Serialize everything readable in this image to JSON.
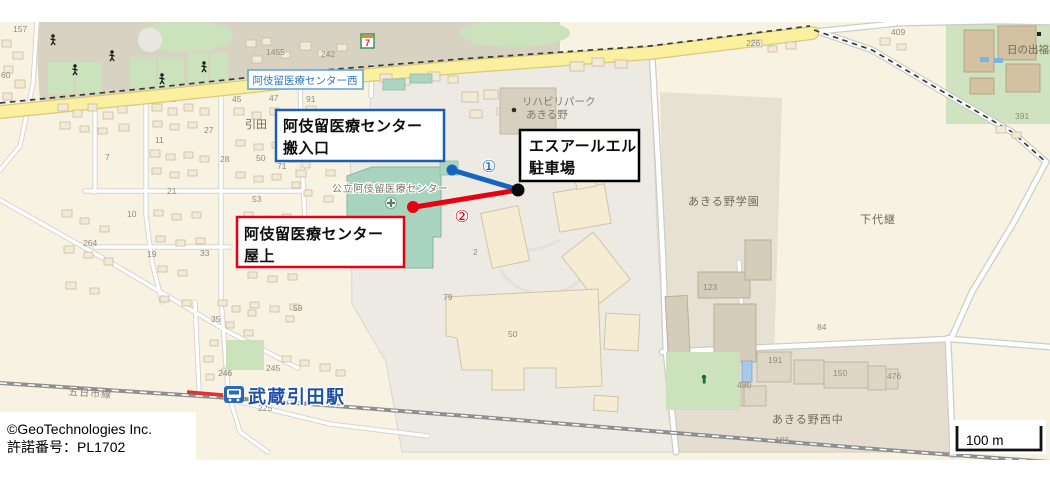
{
  "window": {
    "width": 1050,
    "height": 479
  },
  "annotations": {
    "loading_entrance": {
      "line1": "阿伎留医療センター",
      "line2": "搬入口",
      "border": "#1c5fb0"
    },
    "srl_parking": {
      "line1": "エスアールエル",
      "line2": "駐車場",
      "border": "#000000"
    },
    "rooftop": {
      "line1": "阿伎留医療センター",
      "line2": "屋上",
      "border": "#e60012"
    }
  },
  "routes": {
    "badge1": "①",
    "badge2": "②",
    "color1": "#1565c0",
    "color2": "#e60012",
    "endpoint_color": "#0a0a0a"
  },
  "poi": {
    "bus_stop": "阿伎留医療センター西",
    "station": "武蔵引田駅",
    "convenience_store": "7",
    "hospital": "公立阿伎留医療センター"
  },
  "footer": {
    "copyright_line1": "©GeoTechnologies Inc.",
    "copyright_line2": "許諾番号：PL1702"
  },
  "scale": {
    "label": "100 m"
  },
  "map_labels": [
    {
      "t": "引田",
      "x": 245,
      "y": 128,
      "s": 11,
      "c": "#6f695a"
    },
    {
      "t": "あきる野学園",
      "x": 688,
      "y": 205,
      "s": 11,
      "c": "#6f695a",
      "ls": 1
    },
    {
      "t": "下代継",
      "x": 860,
      "y": 223,
      "s": 11,
      "c": "#6f695a",
      "ls": 1
    },
    {
      "t": "あきる野西中",
      "x": 772,
      "y": 423,
      "s": 11,
      "c": "#6f695a",
      "ls": 1
    },
    {
      "t": "日の出福祉園",
      "x": 1007,
      "y": 53,
      "s": 10.5,
      "c": "#6f695a"
    },
    {
      "t": "リハビリパーク",
      "x": 522,
      "y": 105,
      "s": 10.5,
      "c": "#837b6b"
    },
    {
      "t": "あきる野",
      "x": 526,
      "y": 118,
      "s": 10.5,
      "c": "#837b6b"
    },
    {
      "t": "公立阿伎留医療センター",
      "x": 332,
      "y": 192,
      "s": 10,
      "c": "#7b7365",
      "ls": 0.6,
      "halo": true
    },
    {
      "t": "五日市線",
      "x": 68,
      "y": 395,
      "s": 10,
      "c": "#8a867a",
      "r": 4,
      "ls": 1
    },
    {
      "t": "157",
      "x": 13,
      "y": 32
    },
    {
      "t": "60",
      "x": 1,
      "y": 78
    },
    {
      "t": "1455",
      "x": 266,
      "y": 55
    },
    {
      "t": "242",
      "x": 321,
      "y": 57
    },
    {
      "t": "91",
      "x": 306,
      "y": 102
    },
    {
      "t": "45",
      "x": 232,
      "y": 102
    },
    {
      "t": "47",
      "x": 269,
      "y": 101
    },
    {
      "t": "27",
      "x": 204,
      "y": 133
    },
    {
      "t": "11",
      "x": 155,
      "y": 143
    },
    {
      "t": "7",
      "x": 105,
      "y": 160
    },
    {
      "t": "28",
      "x": 220,
      "y": 162
    },
    {
      "t": "50",
      "x": 256,
      "y": 161
    },
    {
      "t": "71",
      "x": 277,
      "y": 169
    },
    {
      "t": "53",
      "x": 252,
      "y": 202
    },
    {
      "t": "10",
      "x": 127,
      "y": 217
    },
    {
      "t": "21",
      "x": 167,
      "y": 194
    },
    {
      "t": "19",
      "x": 147,
      "y": 257
    },
    {
      "t": "33",
      "x": 200,
      "y": 256
    },
    {
      "t": "264",
      "x": 83,
      "y": 246
    },
    {
      "t": "35",
      "x": 211,
      "y": 322
    },
    {
      "t": "59",
      "x": 293,
      "y": 311
    },
    {
      "t": "246",
      "x": 218,
      "y": 376
    },
    {
      "t": "245",
      "x": 266,
      "y": 371
    },
    {
      "t": "225",
      "x": 258,
      "y": 411
    },
    {
      "t": "226",
      "x": 746,
      "y": 46
    },
    {
      "t": "409",
      "x": 891,
      "y": 35
    },
    {
      "t": "391",
      "x": 1015,
      "y": 119
    },
    {
      "t": "123",
      "x": 703,
      "y": 290
    },
    {
      "t": "84",
      "x": 817,
      "y": 330
    },
    {
      "t": "2",
      "x": 473,
      "y": 255
    },
    {
      "t": "79",
      "x": 443,
      "y": 300
    },
    {
      "t": "50",
      "x": 508,
      "y": 337
    },
    {
      "t": "191",
      "x": 768,
      "y": 363
    },
    {
      "t": "150",
      "x": 833,
      "y": 376
    },
    {
      "t": "476",
      "x": 887,
      "y": 379
    },
    {
      "t": "480",
      "x": 737,
      "y": 388
    },
    {
      "t": "186",
      "x": 775,
      "y": 443
    }
  ]
}
